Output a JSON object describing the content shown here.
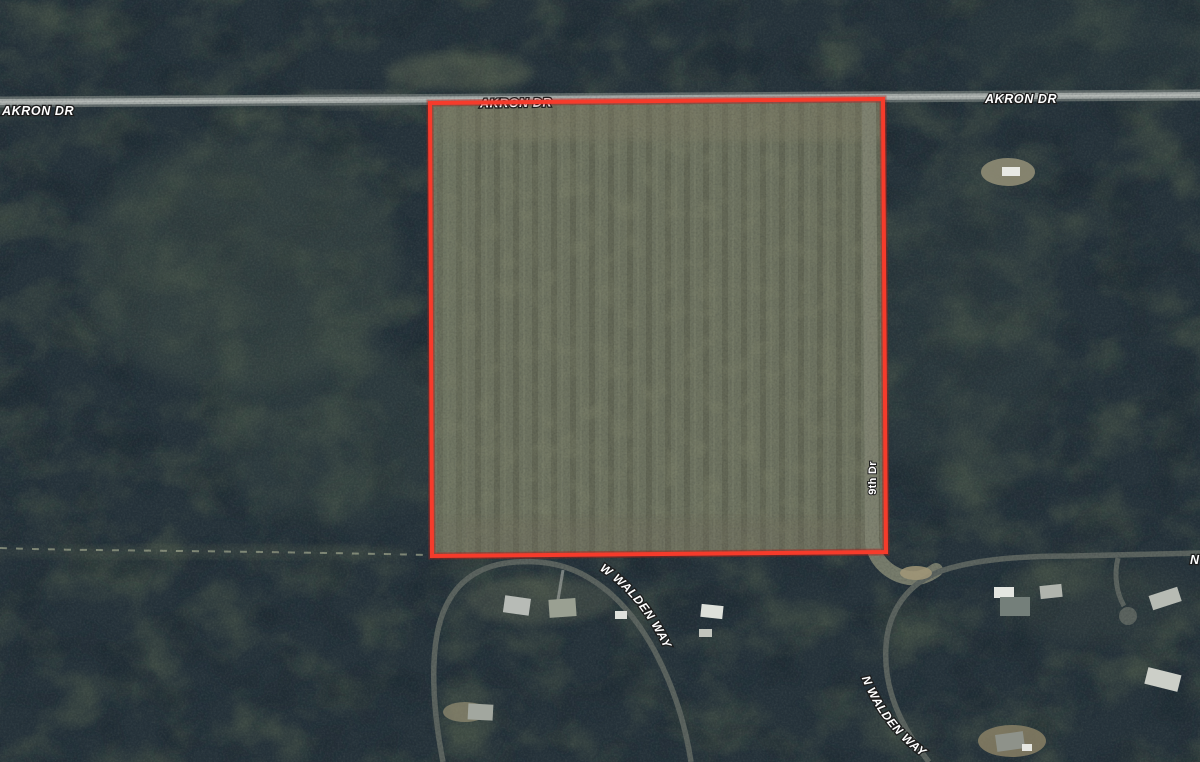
{
  "map": {
    "road_labels": {
      "akron_left": "AKRON DR",
      "akron_center": "AKRON DR",
      "akron_right": "AKRON DR",
      "w_walden_way": "W WALDEN WAY",
      "n_walden_way": "N WALDEN WAY",
      "ninth_dr": "9th Dr",
      "edge_partial": "N"
    },
    "overlay": {
      "parcel_boundary_color": "#f63b2b"
    },
    "colors": {
      "forest_base": "#26333b",
      "field_base": "#6c715f",
      "paved_road": "#a2a8a6",
      "label_fill": "#ffffff",
      "label_outline": "#1d1d1d"
    }
  }
}
